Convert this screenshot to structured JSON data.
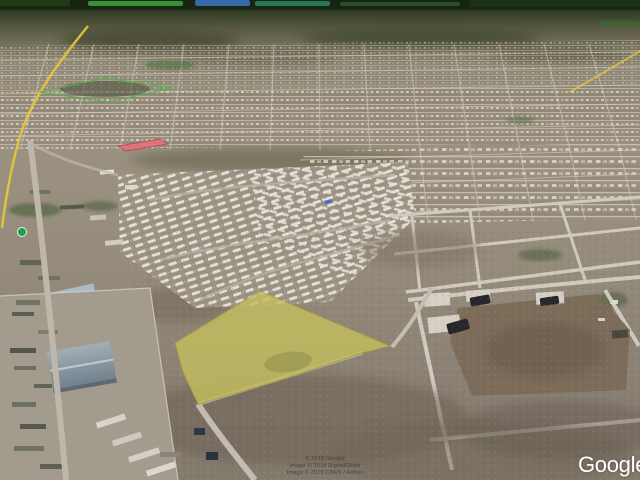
{
  "branding": {
    "logo_text": "Google"
  },
  "attribution": {
    "line1": "© 2018 Google",
    "line2": "Image © 2018 DigitalGlobe",
    "line3": "Image © 2018 CNES / Airbus"
  },
  "overlays": {
    "parcel": {
      "name": "highlighted land parcel",
      "points": "175,343 260,291 390,346 362,353 277,381 198,404 183,372",
      "fill": "#c3bd5f",
      "stroke": "#a8a23a",
      "opacity": "0.82"
    },
    "green_boundary": {
      "name": "green outlined lot",
      "points": "40,92 105,78 172,88 108,102",
      "stroke": "#55b246"
    },
    "red_lot": {
      "name": "red highlighted lot",
      "points": "118,146 160,139 168,144 126,151",
      "fill": "#e2707a",
      "stroke": "#a83d46"
    }
  },
  "markers": {
    "highway_shield": {
      "color": "#21a04c"
    }
  },
  "palette": {
    "horizon_green": "#1e2a18",
    "terrain_tan": "#9b9180",
    "scrub_brown": "#7b6a57",
    "road_gray": "#beb7aa",
    "highway_yellow": "#e5c83c"
  }
}
